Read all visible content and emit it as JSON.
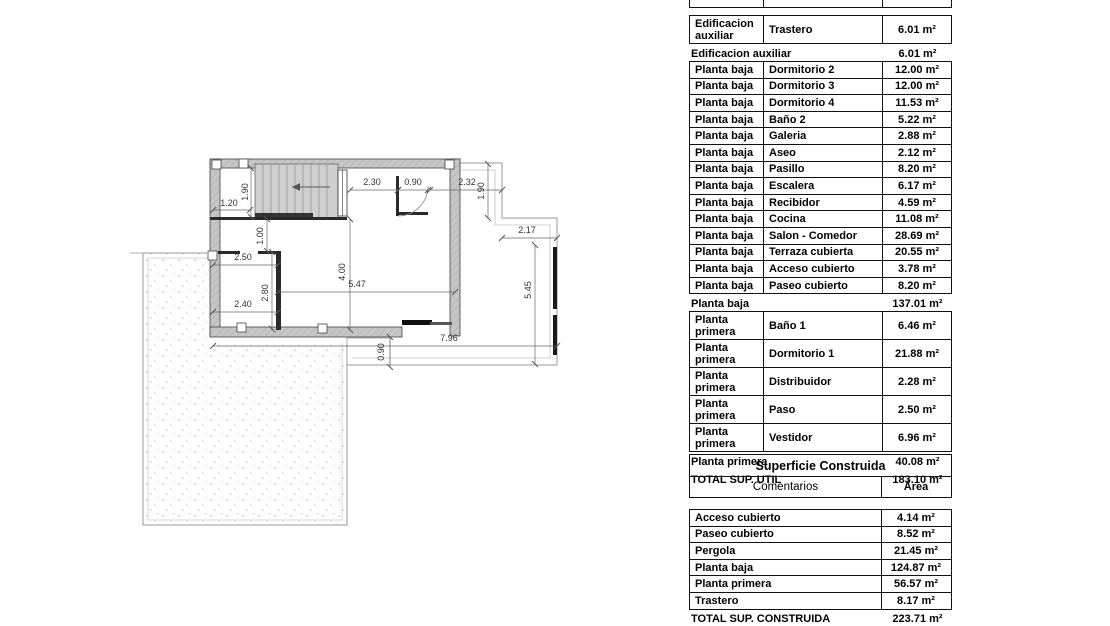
{
  "plan": {
    "dims": [
      {
        "id": "dim-top-left-width",
        "label": "1.20"
      },
      {
        "id": "dim-stair-height",
        "label": "1.90"
      },
      {
        "id": "dim-top-mid-width",
        "label": "2.30"
      },
      {
        "id": "dim-entry-width",
        "label": "0.90"
      },
      {
        "id": "dim-terrace-top-width",
        "label": "2.32"
      },
      {
        "id": "dim-terrace-step-height",
        "label": "1.90"
      },
      {
        "id": "dim-terrace-mid-width",
        "label": "2.17"
      },
      {
        "id": "dim-terrace-side-height",
        "label": "5.45"
      },
      {
        "id": "dim-room-top-width",
        "label": "2.50"
      },
      {
        "id": "dim-passage-height",
        "label": "1.00"
      },
      {
        "id": "dim-hall-height",
        "label": "4.00"
      },
      {
        "id": "dim-hall-width",
        "label": "5.47"
      },
      {
        "id": "dim-room-side-height",
        "label": "2.80"
      },
      {
        "id": "dim-room-bottom-width",
        "label": "2.40"
      },
      {
        "id": "dim-building-width",
        "label": "7.96"
      },
      {
        "id": "dim-walk-step",
        "label": "0.90"
      }
    ]
  },
  "useful_area_table": {
    "rows": [
      {
        "type": "detail",
        "floor": "Edificacion auxiliar",
        "room": "Trastero",
        "area": "6.01 m²"
      },
      {
        "type": "subtotal",
        "label": "Edificacion auxiliar",
        "area": "6.01 m²"
      },
      {
        "type": "detail",
        "floor": "Planta baja",
        "room": "Dormitorio 2",
        "area": "12.00 m²"
      },
      {
        "type": "detail",
        "floor": "Planta baja",
        "room": "Dormitorio 3",
        "area": "12.00 m²"
      },
      {
        "type": "detail",
        "floor": "Planta baja",
        "room": "Dormitorio 4",
        "area": "11.53 m²"
      },
      {
        "type": "detail",
        "floor": "Planta baja",
        "room": "Baño 2",
        "area": "5.22 m²"
      },
      {
        "type": "detail",
        "floor": "Planta baja",
        "room": "Galeria",
        "area": "2.88 m²"
      },
      {
        "type": "detail",
        "floor": "Planta baja",
        "room": "Aseo",
        "area": "2.12 m²"
      },
      {
        "type": "detail",
        "floor": "Planta baja",
        "room": "Pasillo",
        "area": "8.20 m²"
      },
      {
        "type": "detail",
        "floor": "Planta baja",
        "room": "Escalera",
        "area": "6.17 m²"
      },
      {
        "type": "detail",
        "floor": "Planta baja",
        "room": "Recibidor",
        "area": "4.59 m²"
      },
      {
        "type": "detail",
        "floor": "Planta baja",
        "room": "Cocina",
        "area": "11.08 m²"
      },
      {
        "type": "detail",
        "floor": "Planta baja",
        "room": "Salon - Comedor",
        "area": "28.69 m²"
      },
      {
        "type": "detail",
        "floor": "Planta baja",
        "room": "Terraza cubierta",
        "area": "20.55 m²"
      },
      {
        "type": "detail",
        "floor": "Planta baja",
        "room": "Acceso cubierto",
        "area": "3.78 m²"
      },
      {
        "type": "detail",
        "floor": "Planta baja",
        "room": "Paseo cubierto",
        "area": "8.20 m²"
      },
      {
        "type": "subtotal",
        "label": "Planta baja",
        "area": "137.01 m²"
      },
      {
        "type": "detail",
        "floor": "Planta primera",
        "room": "Baño 1",
        "area": "6.46 m²"
      },
      {
        "type": "detail",
        "floor": "Planta primera",
        "room": "Dormitorio 1",
        "area": "21.88 m²"
      },
      {
        "type": "detail",
        "floor": "Planta primera",
        "room": "Distribuidor",
        "area": "2.28 m²"
      },
      {
        "type": "detail",
        "floor": "Planta primera",
        "room": "Paso",
        "area": "2.50 m²"
      },
      {
        "type": "detail",
        "floor": "Planta primera",
        "room": "Vestidor",
        "area": "6.96 m²"
      },
      {
        "type": "subtotal",
        "label": "Planta primera",
        "area": "40.08 m²"
      },
      {
        "type": "total",
        "label": "TOTAL SUP. UTIL",
        "area": "183.10 m²"
      }
    ]
  },
  "built_area_table": {
    "title": "Superficie Construida",
    "columns": {
      "comments": "Comentarios",
      "area": "Área"
    },
    "rows": [
      {
        "label": "Acceso cubierto",
        "area": "4.14 m²"
      },
      {
        "label": "Paseo cubierto",
        "area": "8.52 m²"
      },
      {
        "label": "Pergola",
        "area": "21.45 m²"
      },
      {
        "label": "Planta baja",
        "area": "124.87 m²"
      },
      {
        "label": "Planta primera",
        "area": "56.57 m²"
      },
      {
        "label": "Trastero",
        "area": "8.17 m²"
      }
    ],
    "total": {
      "label": "TOTAL SUP. CONSTRUIDA",
      "area": "223.71 m²"
    }
  }
}
